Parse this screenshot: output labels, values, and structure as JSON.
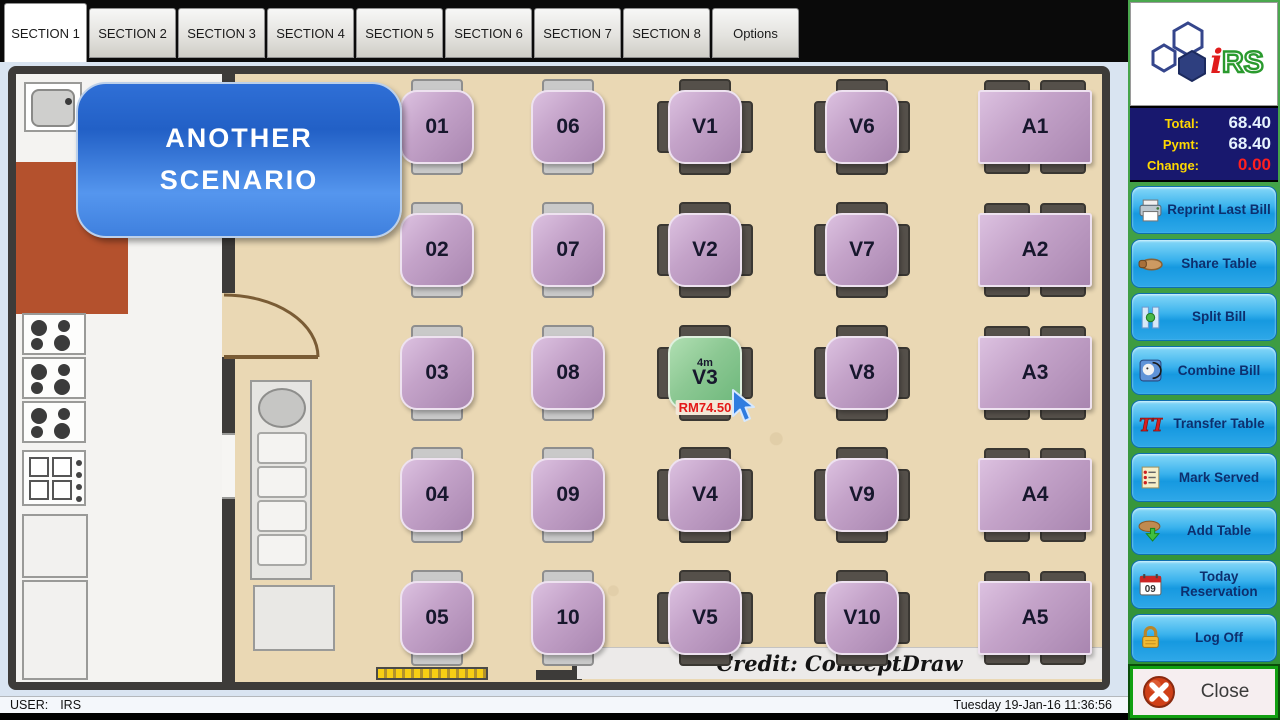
{
  "tabs": {
    "active": "SECTION 1",
    "items": [
      "SECTION 1",
      "SECTION 2",
      "SECTION 3",
      "SECTION 4",
      "SECTION 5",
      "SECTION 6",
      "SECTION 7",
      "SECTION 8",
      "Options"
    ]
  },
  "sidebar": {
    "logo": {
      "i": "i",
      "rs": "RS"
    },
    "totals": {
      "total_label": "Total:",
      "total_value": "68.40",
      "pymt_label": "Pymt:",
      "pymt_value": "68.40",
      "change_label": "Change:",
      "change_value": "0.00"
    },
    "buttons": [
      {
        "name": "reprint-last-bill",
        "icon": "printer-icon",
        "label": "Reprint Last Bill"
      },
      {
        "name": "share-table",
        "icon": "hand-icon",
        "label": "Share Table"
      },
      {
        "name": "split-bill",
        "icon": "split-icon",
        "label": "Split Bill"
      },
      {
        "name": "combine-bill",
        "icon": "combine-icon",
        "label": "Combine Bill"
      },
      {
        "name": "transfer-table",
        "icon": "transfer-icon",
        "label": "Transfer Table"
      },
      {
        "name": "mark-served",
        "icon": "checklist-icon",
        "label": "Mark Served"
      },
      {
        "name": "add-table",
        "icon": "add-table-icon",
        "label": "Add Table"
      },
      {
        "name": "today-reservation",
        "icon": "calendar-icon",
        "label": "Today Reservation"
      },
      {
        "name": "log-off",
        "icon": "lock-icon",
        "label": "Log Off"
      }
    ],
    "close_label": "Close"
  },
  "statusbar": {
    "user_label": "USER:",
    "user_value": "IRS",
    "datetime": "Tuesday 19-Jan-16  11:36:56"
  },
  "floorplan": {
    "callout": {
      "line1": "ANOTHER",
      "line2": "SCENARIO"
    },
    "credit": "Credit: ConceptDraw",
    "selected": {
      "id": "V3",
      "duration": "4m",
      "amount": "RM74.50"
    },
    "tables": [
      {
        "id": "01",
        "kind": "duo",
        "x": 421,
        "y": 53
      },
      {
        "id": "02",
        "kind": "duo",
        "x": 421,
        "y": 176
      },
      {
        "id": "03",
        "kind": "duo",
        "x": 421,
        "y": 299
      },
      {
        "id": "04",
        "kind": "duo",
        "x": 421,
        "y": 421
      },
      {
        "id": "05",
        "kind": "duo",
        "x": 421,
        "y": 544
      },
      {
        "id": "06",
        "kind": "duo",
        "x": 552,
        "y": 53
      },
      {
        "id": "07",
        "kind": "duo",
        "x": 552,
        "y": 176
      },
      {
        "id": "08",
        "kind": "duo",
        "x": 552,
        "y": 299
      },
      {
        "id": "09",
        "kind": "duo",
        "x": 552,
        "y": 421
      },
      {
        "id": "10",
        "kind": "duo",
        "x": 552,
        "y": 544
      },
      {
        "id": "V1",
        "kind": "quad",
        "x": 689,
        "y": 53
      },
      {
        "id": "V2",
        "kind": "quad",
        "x": 689,
        "y": 176
      },
      {
        "id": "V3",
        "kind": "quad",
        "x": 689,
        "y": 299,
        "state": "occupied",
        "duration": "4m",
        "amount": "RM74.50"
      },
      {
        "id": "V4",
        "kind": "quad",
        "x": 689,
        "y": 421
      },
      {
        "id": "V5",
        "kind": "quad",
        "x": 689,
        "y": 544
      },
      {
        "id": "V6",
        "kind": "quad",
        "x": 846,
        "y": 53
      },
      {
        "id": "V7",
        "kind": "quad",
        "x": 846,
        "y": 176
      },
      {
        "id": "V8",
        "kind": "quad",
        "x": 846,
        "y": 299
      },
      {
        "id": "V9",
        "kind": "quad",
        "x": 846,
        "y": 421
      },
      {
        "id": "V10",
        "kind": "quad",
        "x": 846,
        "y": 544
      },
      {
        "id": "A1",
        "kind": "wide",
        "x": 1019,
        "y": 53
      },
      {
        "id": "A2",
        "kind": "wide",
        "x": 1019,
        "y": 176
      },
      {
        "id": "A3",
        "kind": "wide",
        "x": 1019,
        "y": 299
      },
      {
        "id": "A4",
        "kind": "wide",
        "x": 1019,
        "y": 421
      },
      {
        "id": "A5",
        "kind": "wide",
        "x": 1019,
        "y": 544
      }
    ],
    "colors": {
      "table_purple": "#bf9ec5",
      "table_selected_green": "#86c58f",
      "floor_tan": "#ead8b4",
      "wall": "#3d3b39",
      "callout_blue": "#2a6ad4",
      "button_blue": "#2aa3e6"
    }
  }
}
